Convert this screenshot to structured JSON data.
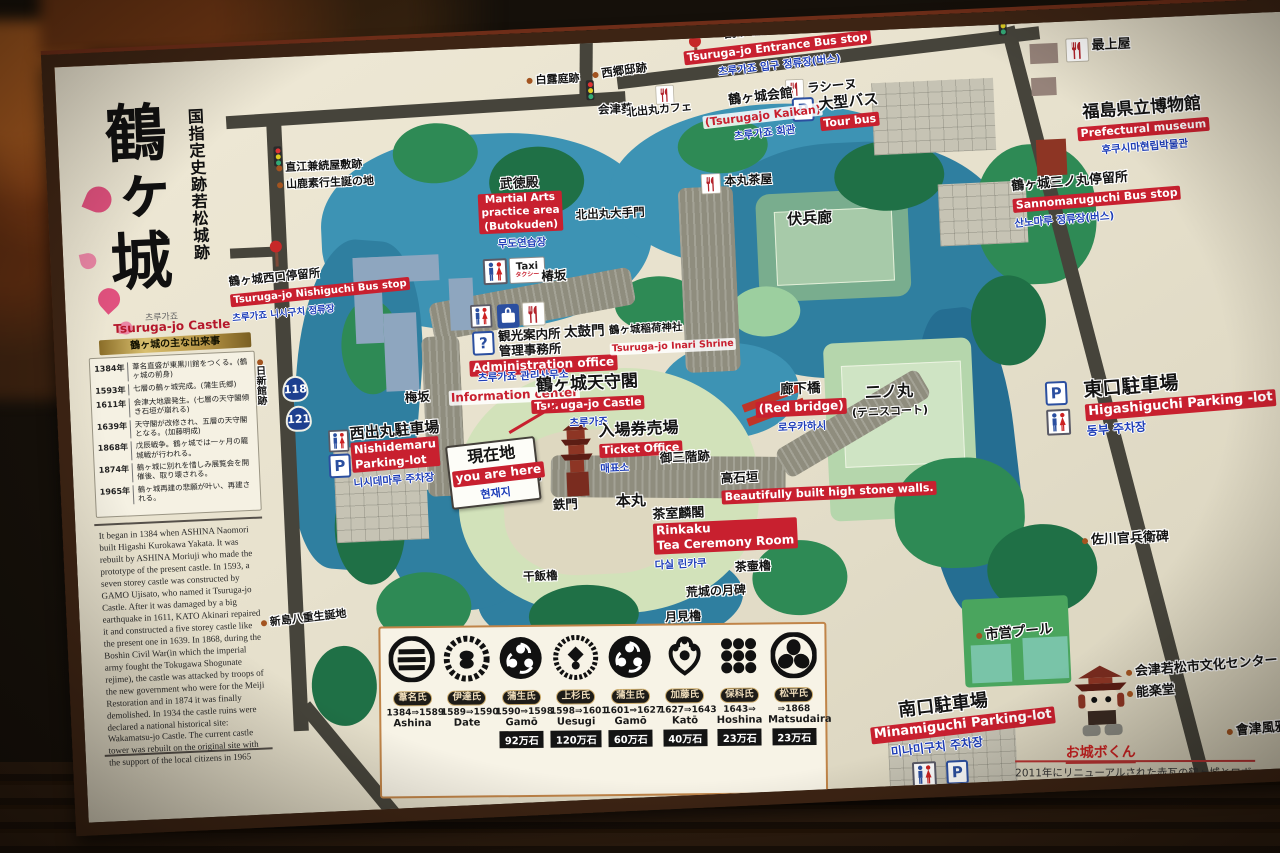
{
  "board": {
    "title": {
      "main": "鶴ヶ城",
      "designation": "国指定史跡若松城跡",
      "korean": "츠루가죠",
      "english": "Tsuruga-jo Castle",
      "banner": "鶴ヶ城の主な出来事"
    },
    "timeline": {
      "events": [
        {
          "year": "1384年",
          "text": "葦名直盛が東黒川館をつくる。(鶴ヶ城の前身)"
        },
        {
          "year": "1593年",
          "text": "七層の鶴ヶ城完成。(蒲生氏郷)"
        },
        {
          "year": "1611年",
          "text": "会津大地震発生。(七層の天守閣傾き石垣が崩れる)"
        },
        {
          "year": "1639年",
          "text": "天守閣が改修され、五層の天守閣となる。(加藤明成)"
        },
        {
          "year": "1868年",
          "text": "戊辰戦争。鶴ヶ城では一ヶ月の籠城戦が行われる。"
        },
        {
          "year": "1874年",
          "text": "鶴ヶ城に別れを惜しみ展覧会を開催後、取り壊される。"
        },
        {
          "year": "1965年",
          "text": "鶴ヶ城再建の悲願が叶い、再建される。"
        }
      ]
    },
    "history_en": "It began in 1384 when ASHINA Naomori built Higashi Kurokawa Yakata. It was rebuilt by ASHINA Moriuji who made the prototype of the present castle.\n In 1593, a seven storey castle was constructed by GAMO Ujisato, who named it Tsuruga-jo Castle. After it was damaged by a big earthquake in 1611, KATO Akinari repaired it and constructed a five storey castle like the present one in 1639.\n In 1868, during the Boshin Civil War(in which the imperial army fought the Tokugawa Shogunate rejime), the castle was attacked by troops of the new government who were for the Meiji Restoration and in 1874 it was finally demolished.\n In 1934 the castle ruins were declared a national historical site: Wakamatsu-jo Castle.\nThe current castle tower was rebuilt on the original site with the support of the local citizens in 1965",
    "map": {
      "labels": {
        "entrance_bus": {
          "jp": "鶴ヶ城入口停留所",
          "en": "Tsuruga-jo Entrance Bus stop",
          "ko": "츠루가죠 입구 정류장(버스)"
        },
        "shirotsuyu": {
          "jp": "白露庭跡"
        },
        "saigo": {
          "jp": "西郷邸跡"
        },
        "aizu_aoi": {
          "jp": "会津葵"
        },
        "kitadomaru_cafe": {
          "jp": "北出丸カフェ"
        },
        "kaikan": {
          "jp": "鶴ヶ城会館",
          "en": "(Tsurugajo Kaikan)",
          "ko": "츠루가죠 회관"
        },
        "racine": {
          "jp": "ラシーヌ"
        },
        "tour_bus": {
          "jp": "大型バス",
          "en": "Tour bus"
        },
        "mogamiya": {
          "jp": "最上屋"
        },
        "museum": {
          "jp": "福島県立博物館",
          "en": "Prefectural museum",
          "ko": "후쿠시마현립박물관"
        },
        "sannomaru_bus": {
          "jp": "鶴ヶ城三ノ丸停留所",
          "en": "Sannomaruguchi Bus stop",
          "ko": "산노마루 정류장(버스)"
        },
        "naoe": {
          "jp": "直江兼続屋敷跡"
        },
        "yamaga": {
          "jp": "山鹿素行生誕の地"
        },
        "butokuden": {
          "jp": "武徳殿",
          "en": "Martial Arts\npractice area\n(Butokuden)",
          "ko": "무도연습장"
        },
        "kitadomaru_gate": {
          "jp": "北出丸大手門"
        },
        "honmaru_chaya": {
          "jp": "本丸茶屋"
        },
        "fukuhei": {
          "jp": "伏兵廊"
        },
        "nishiguchi_bus": {
          "jp": "鶴ヶ城西口停留所",
          "en": "Tsuruga-jo Nishiguchi Bus stop",
          "ko": "츠루가죠 니시구치 정류장"
        },
        "tsubakizaka": {
          "jp": "椿坂"
        },
        "umezaka": {
          "jp": "梅坂"
        },
        "admin": {
          "jp": "観光案内所\n管理事務所",
          "en": "Administration office",
          "ko": "츠루가죠 관리사무소",
          "en2": "Information center"
        },
        "taikomon": {
          "jp": "太鼓門"
        },
        "inari": {
          "jp": "鶴ヶ城稲荷神社",
          "en": "Tsuruga-jo Inari Shrine"
        },
        "tenshu": {
          "jp": "鶴ヶ城天守閣",
          "en": "Tsuruga-jo Castle",
          "ko": "츠루가죠"
        },
        "ticket": {
          "jp": "入場券売場",
          "en": "Ticket Office",
          "ko": "매표소"
        },
        "gosankai": {
          "jp": "御三階跡"
        },
        "nishidemaru_parking": {
          "jp": "西出丸駐車場",
          "en": "Nishidemaru\nParking-lot",
          "ko": "니시데마루 주차장"
        },
        "you_are_here": {
          "jp": "現在地",
          "en": "you are here",
          "ko": "현재지"
        },
        "obirou": {
          "jp": "帯廊"
        },
        "tetsumon": {
          "jp": "鉄門"
        },
        "hoshii": {
          "jp": "干飯櫓"
        },
        "honmaru": {
          "jp": "本丸"
        },
        "rinkaku": {
          "jp": "茶室麟閣",
          "en": "Rinkaku\nTea Ceremony Room",
          "ko": "다실 린카쿠"
        },
        "chatsubo": {
          "jp": "茶壷櫓"
        },
        "koujou": {
          "jp": "荒城の月碑"
        },
        "tsukimi": {
          "jp": "月見櫓"
        },
        "takaishigaki": {
          "jp": "高石垣",
          "en": "Beautifully built high stone walls."
        },
        "roukabashi": {
          "jp": "廊下橋",
          "en": "(Red bridge)",
          "ko": "로우카하시"
        },
        "ninomaru": {
          "jp": "二ノ丸",
          "sub": "(テニスコート)"
        },
        "higashiguchi_parking": {
          "jp": "東口駐車場",
          "en": "Higashiguchi Parking -lot",
          "ko": "동부 주차장"
        },
        "sagawa": {
          "jp": "佐川官兵衛碑"
        },
        "niijima": {
          "jp": "新島八重生誕地"
        },
        "pool": {
          "jp": "市営プール"
        },
        "minamiguchi_parking": {
          "jp": "南口駐車場",
          "en": "Minamiguchi Parking-lot",
          "ko": "미나미구치 주차장"
        },
        "nisshinkan": {
          "jp": "日新館跡"
        }
      },
      "routes": {
        "r118": "118",
        "r121": "121"
      },
      "icons": {
        "parking": "P",
        "taxi_en": "Taxi",
        "taxi_jp": "タクシー",
        "question": "?"
      }
    },
    "crest_panel": {
      "items": [
        {
          "name": "葦名氏",
          "years": "1384⇒1589",
          "romaji": "Ashina",
          "koku": ""
        },
        {
          "name": "伊達氏",
          "years": "1589⇒1590",
          "romaji": "Date",
          "koku": ""
        },
        {
          "name": "蒲生氏",
          "years": "1590⇒1598",
          "romaji": "Gamō",
          "koku": "92万石"
        },
        {
          "name": "上杉氏",
          "years": "1598⇒1601",
          "romaji": "Uesugi",
          "koku": "120万石"
        },
        {
          "name": "蒲生氏",
          "years": "1601⇒1627",
          "romaji": "Gamō",
          "koku": "60万石"
        },
        {
          "name": "加藤氏",
          "years": "1627⇒1643",
          "romaji": "Katō",
          "koku": "40万石"
        },
        {
          "name": "保科氏",
          "years": "1643⇒",
          "romaji": "Hoshina",
          "koku": "23万石"
        },
        {
          "name": "松平氏",
          "years": "⇒1868",
          "romaji": "Matsudaira",
          "koku": "23万石"
        }
      ]
    },
    "mascot": {
      "name": "お城ボくん",
      "description": "2011年にリニューアルされた赤瓦の鶴ヶ城とロボットを融合したキャラクター「お城ボくん」。\n会津出身の笹川ひろし氏作成。"
    },
    "right_list": {
      "item1": "会津若松市文化センター",
      "item2": "能楽堂",
      "item3": "會津風雅堂"
    }
  }
}
